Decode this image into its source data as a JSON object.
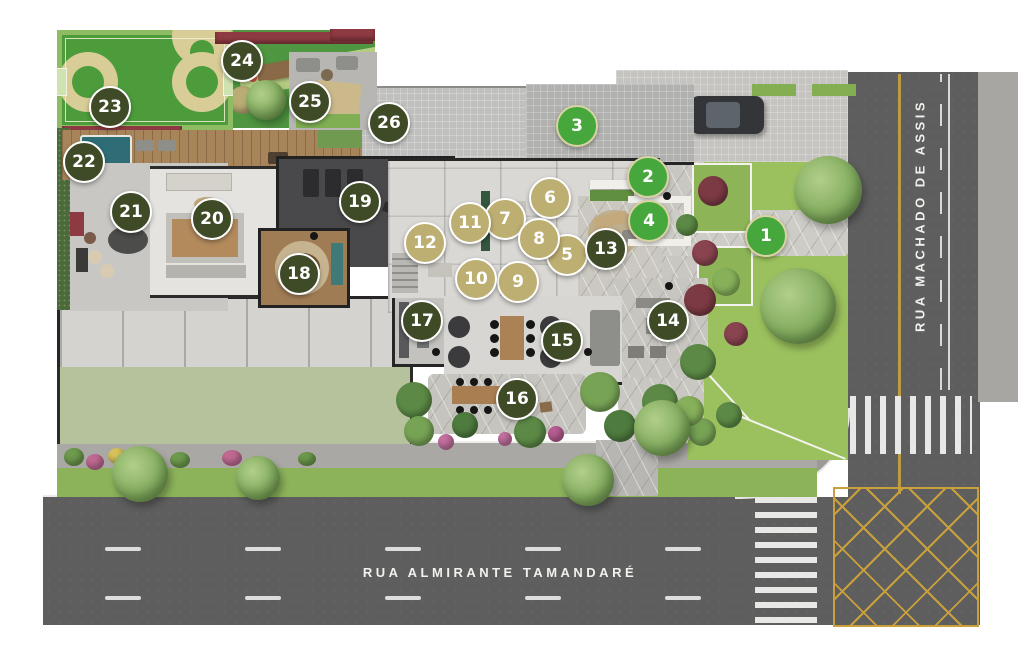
{
  "plan": {
    "streets": {
      "bottom": "RUA ALMIRANTE TAMANDARÉ",
      "right": "RUA MACHADO DE ASSIS"
    },
    "marker_colors": {
      "green": "#46a73c",
      "tan": "#bdae72",
      "olive": "#3f4a27"
    },
    "marker_border_colors": {
      "green": "#d9d3a4",
      "tan": "#ffffff",
      "olive": "#ffffff"
    },
    "markers": [
      {
        "number": "1",
        "color": "green",
        "x": 766,
        "y": 236
      },
      {
        "number": "2",
        "color": "green",
        "x": 648,
        "y": 177
      },
      {
        "number": "3",
        "color": "green",
        "x": 577,
        "y": 126
      },
      {
        "number": "4",
        "color": "green",
        "x": 649,
        "y": 221
      },
      {
        "number": "5",
        "color": "tan",
        "x": 567,
        "y": 255
      },
      {
        "number": "6",
        "color": "tan",
        "x": 550,
        "y": 198
      },
      {
        "number": "7",
        "color": "tan",
        "x": 505,
        "y": 219
      },
      {
        "number": "8",
        "color": "tan",
        "x": 539,
        "y": 239
      },
      {
        "number": "9",
        "color": "tan",
        "x": 518,
        "y": 282
      },
      {
        "number": "10",
        "color": "tan",
        "x": 476,
        "y": 279
      },
      {
        "number": "11",
        "color": "tan",
        "x": 470,
        "y": 223
      },
      {
        "number": "12",
        "color": "tan",
        "x": 425,
        "y": 243
      },
      {
        "number": "13",
        "color": "olive",
        "x": 606,
        "y": 249
      },
      {
        "number": "14",
        "color": "olive",
        "x": 668,
        "y": 321
      },
      {
        "number": "15",
        "color": "olive",
        "x": 562,
        "y": 341
      },
      {
        "number": "16",
        "color": "olive",
        "x": 517,
        "y": 399
      },
      {
        "number": "17",
        "color": "olive",
        "x": 422,
        "y": 321
      },
      {
        "number": "18",
        "color": "olive",
        "x": 299,
        "y": 274
      },
      {
        "number": "19",
        "color": "olive",
        "x": 360,
        "y": 202
      },
      {
        "number": "20",
        "color": "olive",
        "x": 212,
        "y": 219
      },
      {
        "number": "21",
        "color": "olive",
        "x": 131,
        "y": 212
      },
      {
        "number": "22",
        "color": "olive",
        "x": 84,
        "y": 162
      },
      {
        "number": "23",
        "color": "olive",
        "x": 110,
        "y": 107
      },
      {
        "number": "24",
        "color": "olive",
        "x": 242,
        "y": 61
      },
      {
        "number": "25",
        "color": "olive",
        "x": 310,
        "y": 102
      },
      {
        "number": "26",
        "color": "olive",
        "x": 389,
        "y": 123
      }
    ]
  }
}
